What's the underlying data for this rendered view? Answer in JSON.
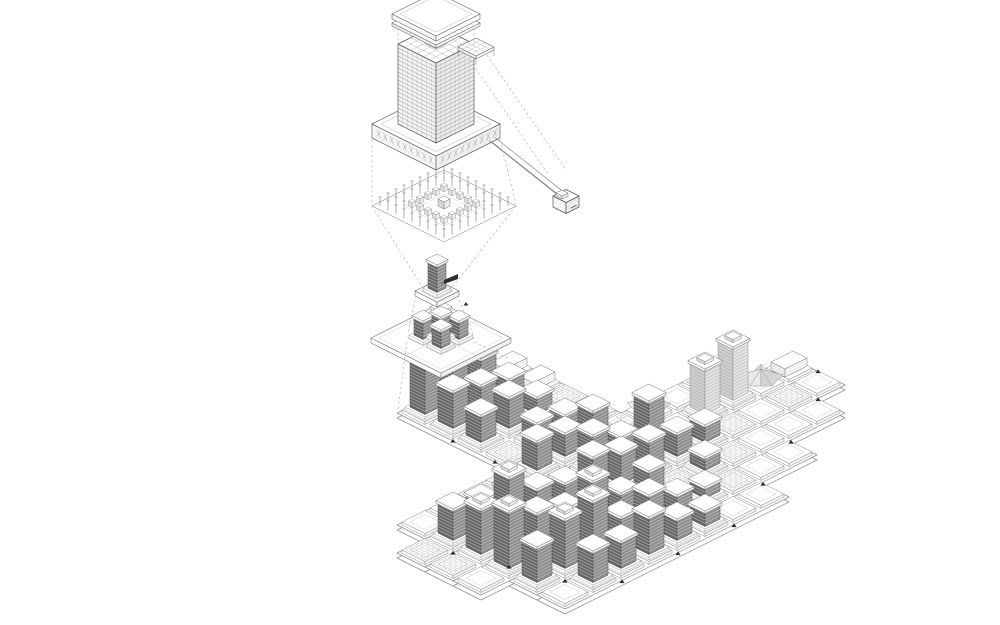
{
  "figure": {
    "type": "exploded-axonometric-architecture-diagram",
    "components": [
      "roof-plate",
      "facade-tower",
      "podium-ring",
      "structural-bay-fragment",
      "transfer-beam",
      "beam-node",
      "column-grid-plate",
      "tower-unit",
      "tower-cluster",
      "masterplan"
    ]
  },
  "colors": {
    "ink": "#5a5a5a",
    "faint": "#a9a9a9",
    "lighter": "#c6c6c6",
    "darkL": "#676767",
    "darkR": "#8f8f8f",
    "stripe": "#dedede",
    "lightL": "#cdcdcd",
    "lightR": "#e3e3e3",
    "pavA": "#eaeaea",
    "pavB": "#d5d5d5",
    "white": "#ffffff",
    "paper": "#fdfdfd",
    "black": "#2e2e2e"
  },
  "scene": {
    "detail": {
      "origin": [
        436,
        132
      ],
      "podium": {
        "side": 64,
        "inner": 34,
        "height": 14,
        "zTop": 8
      },
      "tower": {
        "side": 38,
        "zBase": 8,
        "height": 80,
        "floors": 20,
        "mullions": 8
      },
      "roof": {
        "side": 44,
        "lower": {
          "z": 106,
          "th": 3
        },
        "upper": {
          "z": 113,
          "th": 5
        }
      },
      "beam": {
        "x": 20,
        "y0": 36,
        "y1": 104,
        "z0": 0,
        "z1": -20,
        "halfw": 3
      },
      "node": {
        "cx": 20,
        "cy": 110,
        "z": -30,
        "side": 13,
        "height": 11
      },
      "fragment": {
        "origin": [
          476,
          50
        ],
        "side": 18,
        "th": 3,
        "legs": 6
      },
      "columns": {
        "origin": [
          444,
          206
        ],
        "plate": 72,
        "spacing": 8,
        "rings": [
          4,
          3
        ],
        "stubRing": 2
      }
    },
    "scale2": {
      "origin": [
        437,
        296
      ],
      "podium": {
        "side": 22,
        "inner": 11,
        "height": 5
      },
      "tower": {
        "side": 9,
        "height": 26
      },
      "flag": {
        "pts": [
          [
            444,
            280
          ],
          [
            458,
            274
          ],
          [
            458,
            279
          ],
          [
            444,
            284
          ]
        ],
        "line": [
          441,
          284,
          445,
          281
        ]
      },
      "tick": [
        466,
        304
      ]
    },
    "scale3": {
      "origin": [
        441,
        338
      ],
      "plate": {
        "side": 35,
        "height": 5
      },
      "pods": [
        [
          -9,
          -9
        ],
        [
          9,
          -9
        ],
        [
          -9,
          9
        ],
        [
          9,
          9
        ],
        [
          0,
          0
        ]
      ],
      "towers": [
        [
          -9,
          -9,
          17
        ],
        [
          9,
          -9,
          17
        ],
        [
          -9,
          9,
          17
        ],
        [
          9,
          9,
          17
        ],
        [
          0,
          0,
          21
        ]
      ],
      "towerSide": 9
    },
    "masterplan": {
      "origin": [
        397,
        413
      ],
      "cell": 28,
      "x0": -140,
      "y0": 112,
      "rowStartK": [
        1,
        0,
        0,
        0,
        1,
        1
      ],
      "rowEndK": [
        12,
        14,
        14,
        13,
        11,
        9
      ],
      "quadrant": {
        "n": 4
      },
      "towers": [
        [
          5,
          0,
          28
        ],
        [
          6,
          0,
          22
        ],
        [
          7,
          0,
          30
        ],
        [
          1,
          1,
          30
        ],
        [
          2,
          1,
          24
        ],
        [
          3,
          1,
          20
        ],
        [
          6,
          1,
          34
        ],
        [
          7,
          1,
          18
        ],
        [
          8,
          1,
          40
        ],
        [
          1,
          2,
          44
        ],
        [
          2,
          2,
          62
        ],
        [
          3,
          2,
          36
        ],
        [
          4,
          2,
          28
        ],
        [
          5,
          2,
          40
        ],
        [
          6,
          2,
          30
        ],
        [
          7,
          2,
          28
        ],
        [
          8,
          2,
          22
        ],
        [
          9,
          2,
          16
        ],
        [
          1,
          3,
          56
        ],
        [
          2,
          3,
          40
        ],
        [
          3,
          3,
          30
        ],
        [
          4,
          3,
          44
        ],
        [
          5,
          3,
          18
        ],
        [
          6,
          3,
          26
        ],
        [
          8,
          3,
          12
        ],
        [
          1,
          4,
          34
        ],
        [
          2,
          4,
          48
        ],
        [
          3,
          4,
          52
        ],
        [
          4,
          4,
          22
        ],
        [
          5,
          4,
          30
        ],
        [
          6,
          4,
          16
        ],
        [
          7,
          4,
          10
        ],
        [
          2,
          5,
          30
        ],
        [
          3,
          5,
          26
        ],
        [
          4,
          5,
          36
        ],
        [
          5,
          5,
          20
        ],
        [
          6,
          5,
          14
        ]
      ],
      "lightTowers": [
        [
          10,
          1,
          44
        ],
        [
          11,
          1,
          52
        ]
      ],
      "pavilions": [
        [
          9,
          0
        ],
        [
          12,
          1
        ]
      ],
      "gardens": [
        [
          4,
          1
        ],
        [
          8,
          0
        ],
        [
          11,
          0
        ]
      ],
      "slabs": [
        [
          13,
          1
        ]
      ],
      "motifs": [
        [
          0,
          1
        ],
        [
          0,
          2
        ],
        [
          3,
          0
        ],
        [
          4,
          0
        ],
        [
          5,
          1
        ],
        [
          7,
          3
        ],
        [
          9,
          3
        ],
        [
          10,
          2
        ],
        [
          12,
          2
        ],
        [
          8,
          4
        ]
      ],
      "microlabels": [
        [
          1,
          2
        ],
        [
          2,
          3
        ],
        [
          4,
          3
        ],
        [
          6,
          1
        ],
        [
          8,
          2
        ],
        [
          10,
          1
        ],
        [
          3,
          4
        ],
        [
          5,
          0
        ]
      ],
      "quadTowers": [
        [
          0,
          0,
          46
        ],
        [
          1,
          0,
          34
        ],
        [
          2,
          0,
          26
        ],
        [
          0,
          1,
          36
        ],
        [
          1,
          1,
          28
        ],
        [
          2,
          1,
          20
        ],
        [
          0,
          2,
          26
        ],
        [
          1,
          2,
          30
        ],
        [
          2,
          2,
          16
        ],
        [
          1,
          3,
          18
        ],
        [
          2,
          3,
          12
        ]
      ],
      "quadSlabs": [
        [
          3,
          0
        ],
        [
          3,
          1
        ]
      ],
      "quadMotifs": [
        [
          3,
          2
        ],
        [
          0,
          3
        ],
        [
          3,
          3
        ]
      ],
      "quadMicrolabels": [
        [
          0,
          1
        ],
        [
          1,
          2
        ],
        [
          2,
          0
        ]
      ],
      "markers": [
        [
          -112,
          168
        ],
        [
          -98,
          210
        ],
        [
          -84,
          252
        ],
        [
          -56,
          281
        ],
        [
          0,
          281
        ],
        [
          56,
          281
        ],
        [
          112,
          254
        ],
        [
          168,
          226
        ],
        [
          224,
          197
        ],
        [
          252,
          169
        ],
        [
          0,
          56
        ],
        [
          0,
          98
        ]
      ]
    },
    "dashes": [
      [
        398,
        28,
        398,
        46
      ],
      [
        474,
        28,
        474,
        46
      ],
      [
        372,
        140,
        372,
        204
      ],
      [
        500,
        140,
        516,
        204
      ],
      [
        372,
        206,
        424,
        290
      ],
      [
        516,
        206,
        450,
        290
      ],
      [
        415,
        300,
        408,
        334
      ],
      [
        459,
        300,
        473,
        334
      ],
      [
        407,
        342,
        398,
        410
      ],
      [
        474,
        342,
        508,
        358
      ],
      [
        470,
        60,
        548,
        174
      ],
      [
        487,
        55,
        566,
        170
      ]
    ]
  }
}
